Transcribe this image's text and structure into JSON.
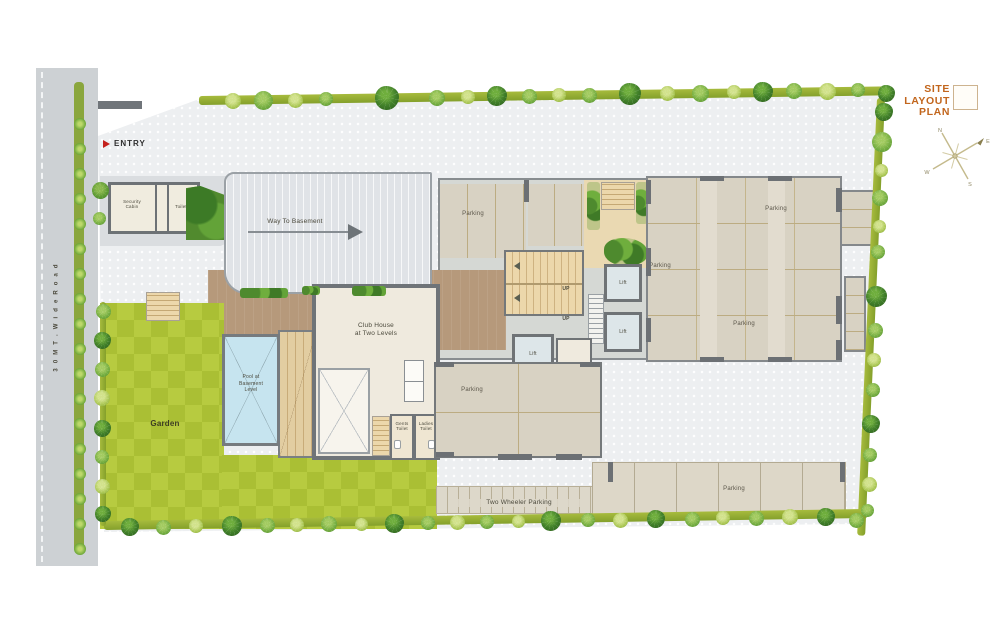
{
  "plan": {
    "title": "SITE\nLAYOUT\nPLAN",
    "road_name": "3 0   M T .   W i d e   R o a d",
    "entry_label": "ENTRY",
    "security_cabin": "Security\nCabin",
    "gate_toilet": "Toilet",
    "ramp_label": "Way To Basement",
    "club_house": "Club House\nat Two Levels",
    "pool": "Pool at\nBasement\nLevel",
    "garden": "Garden",
    "gents_toilet": "Gents\nToilet",
    "ladies_toilet": "Ladies\nToilet",
    "up": "UP",
    "lift": "Lift",
    "parking": "Parking",
    "two_wheeler_parking": "Two Wheeler Parking"
  },
  "compass": {
    "n": "N",
    "e": "E",
    "s": "S",
    "w": "W"
  },
  "colors": {
    "title_orange": "#c2661d",
    "entry_red": "#c4201c",
    "hedge_olive": "#8ea631",
    "garden_light": "#b7cb40",
    "garden_dark": "#aabf34",
    "pool_blue": "#c6e4ef",
    "terrace_brown": "#b6997b",
    "parking_beige": "#d8d2c3",
    "road_gray": "#cdd1d4",
    "paving_gray": "#edeff1"
  }
}
